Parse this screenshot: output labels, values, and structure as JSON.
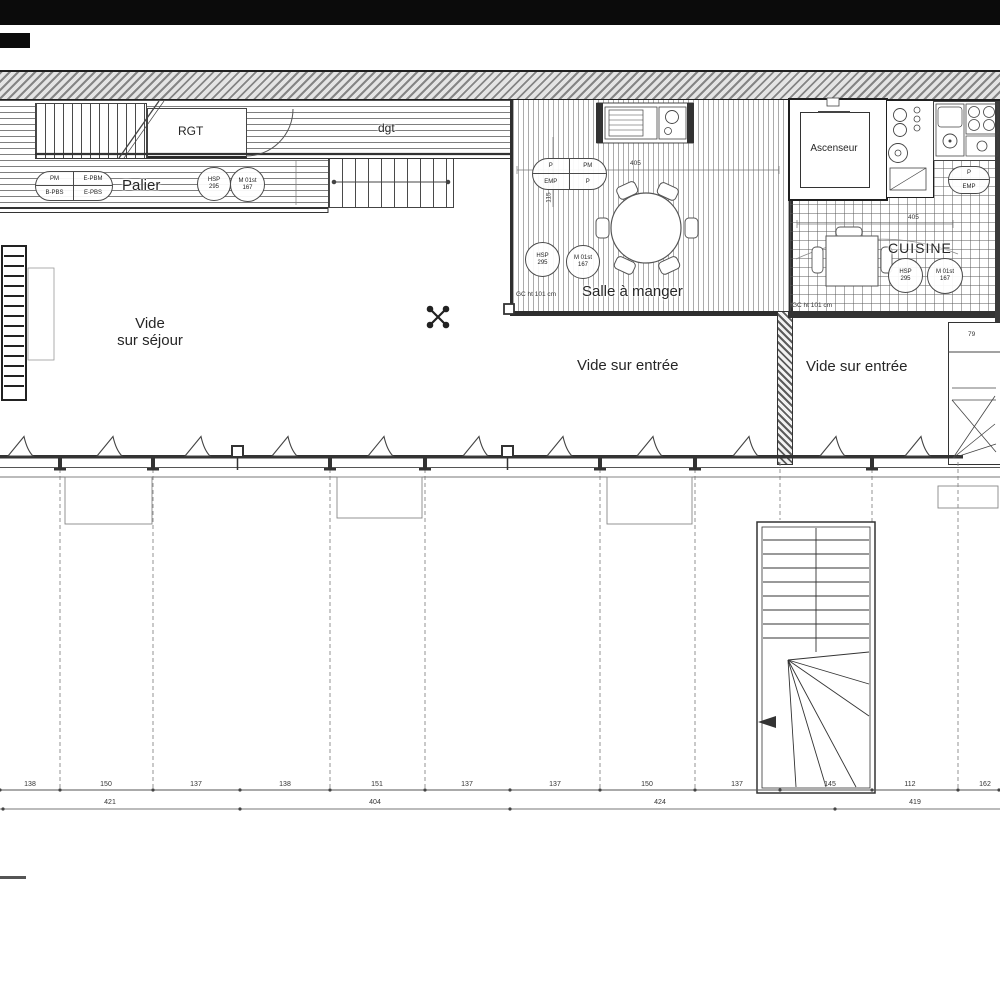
{
  "labels": {
    "rgt": "RGT",
    "palier": "Palier",
    "dgt": "dgt",
    "salle_a_manger": "Salle à manger",
    "cuisine": "CUISINE",
    "ascenseur": "Ascenseur",
    "vide_sejour_1": "Vide",
    "vide_sejour_2": "sur séjour",
    "vide_entree_center": "Vide sur entrée",
    "vide_entree_right": "Vide sur entrée"
  },
  "tags": {
    "palier_oval": {
      "tl": "PM",
      "tr": "E-PBM",
      "bl": "B-PBS",
      "br": "E-PBS"
    },
    "dining_oval": {
      "tl": "P",
      "tr": "PM",
      "bl": "EMP",
      "br": "P"
    },
    "kitchen_oval": {
      "top": "P",
      "bottom": "EMP"
    },
    "hsp": {
      "l1": "HSP",
      "l2": "295"
    },
    "m01": {
      "l1": "M 01st",
      "l2": "167"
    }
  },
  "annotations": {
    "gc_dining": "GC ht 101 cm",
    "gc_kitchen": "GC ht 101 cm",
    "shaft_dim": "79",
    "dining_width": "405",
    "dining_depth": "115",
    "kitchen_width": "405"
  },
  "dimensions": {
    "top_row": [
      "138",
      "150",
      "137",
      "138",
      "151",
      "137",
      "137",
      "150",
      "137",
      "145",
      "112",
      "162"
    ],
    "bottom_row": [
      "421",
      "404",
      "424",
      "419"
    ]
  },
  "colors": {
    "ink": "#333333",
    "wall_fill": "#e4e4e4",
    "paper": "#ffffff"
  }
}
